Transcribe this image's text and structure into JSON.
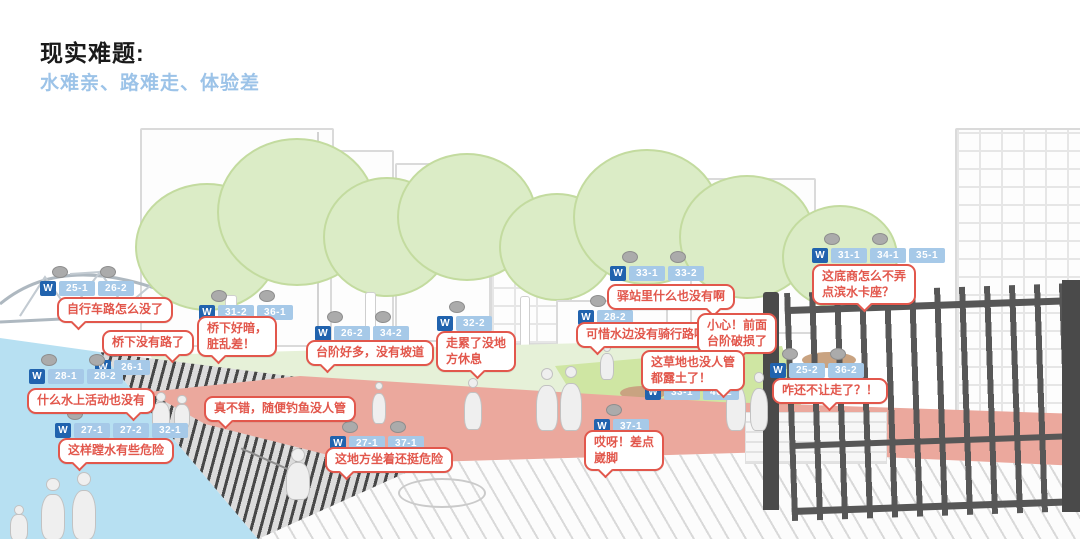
{
  "slide": {
    "title": "现实难题:",
    "subtitle": "水难亲、路难走、体验差"
  },
  "colors": {
    "title": "#1A1A1A",
    "subtitle": "#9CC3E8",
    "bubble_accent": "#E2574C",
    "tag_dark_blue": "#2163AE",
    "tag_light_blue": "#A6C9E8",
    "water": "#B7E0F2",
    "tree_green": "#DBECC6",
    "lawn_green": "#CFE6A3",
    "path_pink": "#EBA89D"
  },
  "w_label": "W",
  "bubbles": [
    {
      "id": "bike-lane",
      "text": "自行车路怎么没了",
      "x": 57,
      "y": 297,
      "tail": "bl"
    },
    {
      "id": "under-bridge-path",
      "text": "桥下没有路了",
      "x": 102,
      "y": 330,
      "tail": "br"
    },
    {
      "id": "water-activities",
      "text": "什么水上活动也没有",
      "x": 27,
      "y": 388,
      "tail": "br"
    },
    {
      "id": "wading",
      "text": "这样蹚水有些危险",
      "x": 58,
      "y": 438,
      "tail": "bl"
    },
    {
      "id": "dark-bridge",
      "text": "桥下好暗，\n脏乱差！",
      "x": 197,
      "y": 316,
      "tail": "bl"
    },
    {
      "id": "many-steps",
      "text": "台阶好多，没有坡道",
      "x": 306,
      "y": 340,
      "tail": "bl"
    },
    {
      "id": "no-rest",
      "text": "走累了没地\n方休息",
      "x": 436,
      "y": 331,
      "tail": "bc"
    },
    {
      "id": "fishing",
      "text": "真不错，随便钓鱼没人管",
      "x": 204,
      "y": 396,
      "tail": "bl"
    },
    {
      "id": "sitting-danger",
      "text": "这地方坐着还挺危险",
      "x": 325,
      "y": 447,
      "tail": "bl"
    },
    {
      "id": "station-empty",
      "text": "驿站里什么也没有啊",
      "x": 607,
      "y": 284,
      "tail": "br"
    },
    {
      "id": "no-cycling-path",
      "text": "可惜水边没有骑行路啊！",
      "x": 576,
      "y": 322,
      "tail": "bl"
    },
    {
      "id": "broken-steps",
      "text": "小心！前面\n台阶破损了",
      "x": 697,
      "y": 313,
      "tail": "bc"
    },
    {
      "id": "bare-grass",
      "text": "这草地也没人管\n都露土了！",
      "x": 641,
      "y": 350,
      "tail": "br"
    },
    {
      "id": "waterfront-seating",
      "text": "这底商怎么不弄\n点滨水卡座？",
      "x": 812,
      "y": 264,
      "tail": "bc"
    },
    {
      "id": "gate-closed",
      "text": "咋还不让走了？！",
      "x": 772,
      "y": 378,
      "tail": "bc"
    },
    {
      "id": "ankle",
      "text": "哎呀！差点\n崴脚",
      "x": 584,
      "y": 430,
      "tail": "bl"
    }
  ],
  "tags": [
    {
      "id": "tag-bridge-top",
      "x": 40,
      "y": 281,
      "numbers": [
        "25-1",
        "26-2"
      ],
      "heads": 2
    },
    {
      "id": "tag-under-bridge",
      "x": 95,
      "y": 360,
      "numbers": [
        "26-1"
      ],
      "heads": 1
    },
    {
      "id": "tag-water-activities",
      "x": 29,
      "y": 369,
      "numbers": [
        "28-1",
        "28-2"
      ],
      "heads": 2
    },
    {
      "id": "tag-wading",
      "x": 55,
      "y": 423,
      "numbers": [
        "27-1",
        "27-2",
        "32-1"
      ],
      "heads": 1
    },
    {
      "id": "tag-dark-bridge",
      "x": 199,
      "y": 305,
      "numbers": [
        "31-2",
        "36-1"
      ],
      "heads": 2
    },
    {
      "id": "tag-many-steps",
      "x": 315,
      "y": 326,
      "numbers": [
        "26-2",
        "34-2"
      ],
      "heads": 2
    },
    {
      "id": "tag-no-rest",
      "x": 437,
      "y": 316,
      "numbers": [
        "32-2"
      ],
      "heads": 1
    },
    {
      "id": "tag-sitting",
      "x": 330,
      "y": 436,
      "numbers": [
        "27-1",
        "37-1"
      ],
      "heads": 2
    },
    {
      "id": "tag-station",
      "x": 610,
      "y": 266,
      "numbers": [
        "33-1",
        "33-2"
      ],
      "heads": 2
    },
    {
      "id": "tag-cycling",
      "x": 578,
      "y": 310,
      "numbers": [
        "28-2"
      ],
      "heads": 1
    },
    {
      "id": "tag-grass",
      "x": 645,
      "y": 385,
      "numbers": [
        "33-1",
        "40-2"
      ],
      "heads": 0
    },
    {
      "id": "tag-shops",
      "x": 812,
      "y": 248,
      "numbers": [
        "31-1",
        "34-1",
        "35-1"
      ],
      "heads": 2
    },
    {
      "id": "tag-gate",
      "x": 770,
      "y": 363,
      "numbers": [
        "25-2",
        "36-2"
      ],
      "heads": 2
    },
    {
      "id": "tag-ankle",
      "x": 594,
      "y": 419,
      "numbers": [
        "37-1"
      ],
      "heads": 1
    }
  ]
}
